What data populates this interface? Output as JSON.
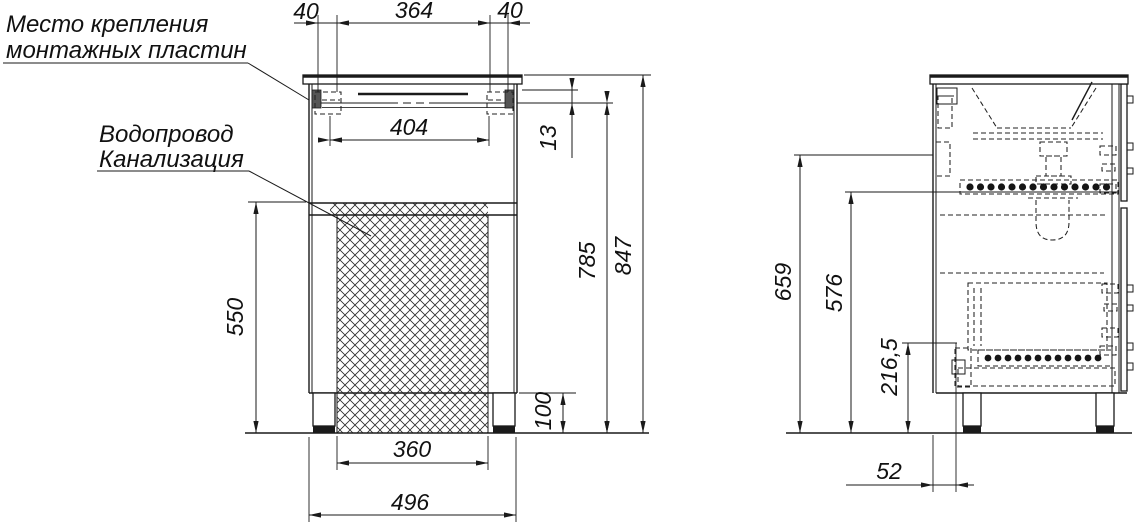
{
  "drawing": {
    "background": "#ffffff",
    "line_color": "#1a1a1a",
    "hatch_color": "#2a2a2a",
    "annotations": {
      "mounting_plates": {
        "line1": "Место крепления",
        "line2": "монтажных пластин"
      },
      "plumbing": {
        "line1": "Водопровод",
        "line2": "Канализация"
      }
    },
    "front_view": {
      "dims": {
        "top_left_offset": "40",
        "mounting_span": "364",
        "top_right_offset": "40",
        "plate_centers": "404",
        "plate_drop": "13",
        "mount_height": "785",
        "total_height": "847",
        "clearance_height": "550",
        "leg_height": "100",
        "opening_width": "360",
        "cabinet_width": "496"
      }
    },
    "side_view": {
      "dims": {
        "supply_height": "659",
        "slide_height": "576",
        "drain_height": "216,5",
        "back_offset": "52"
      }
    }
  }
}
